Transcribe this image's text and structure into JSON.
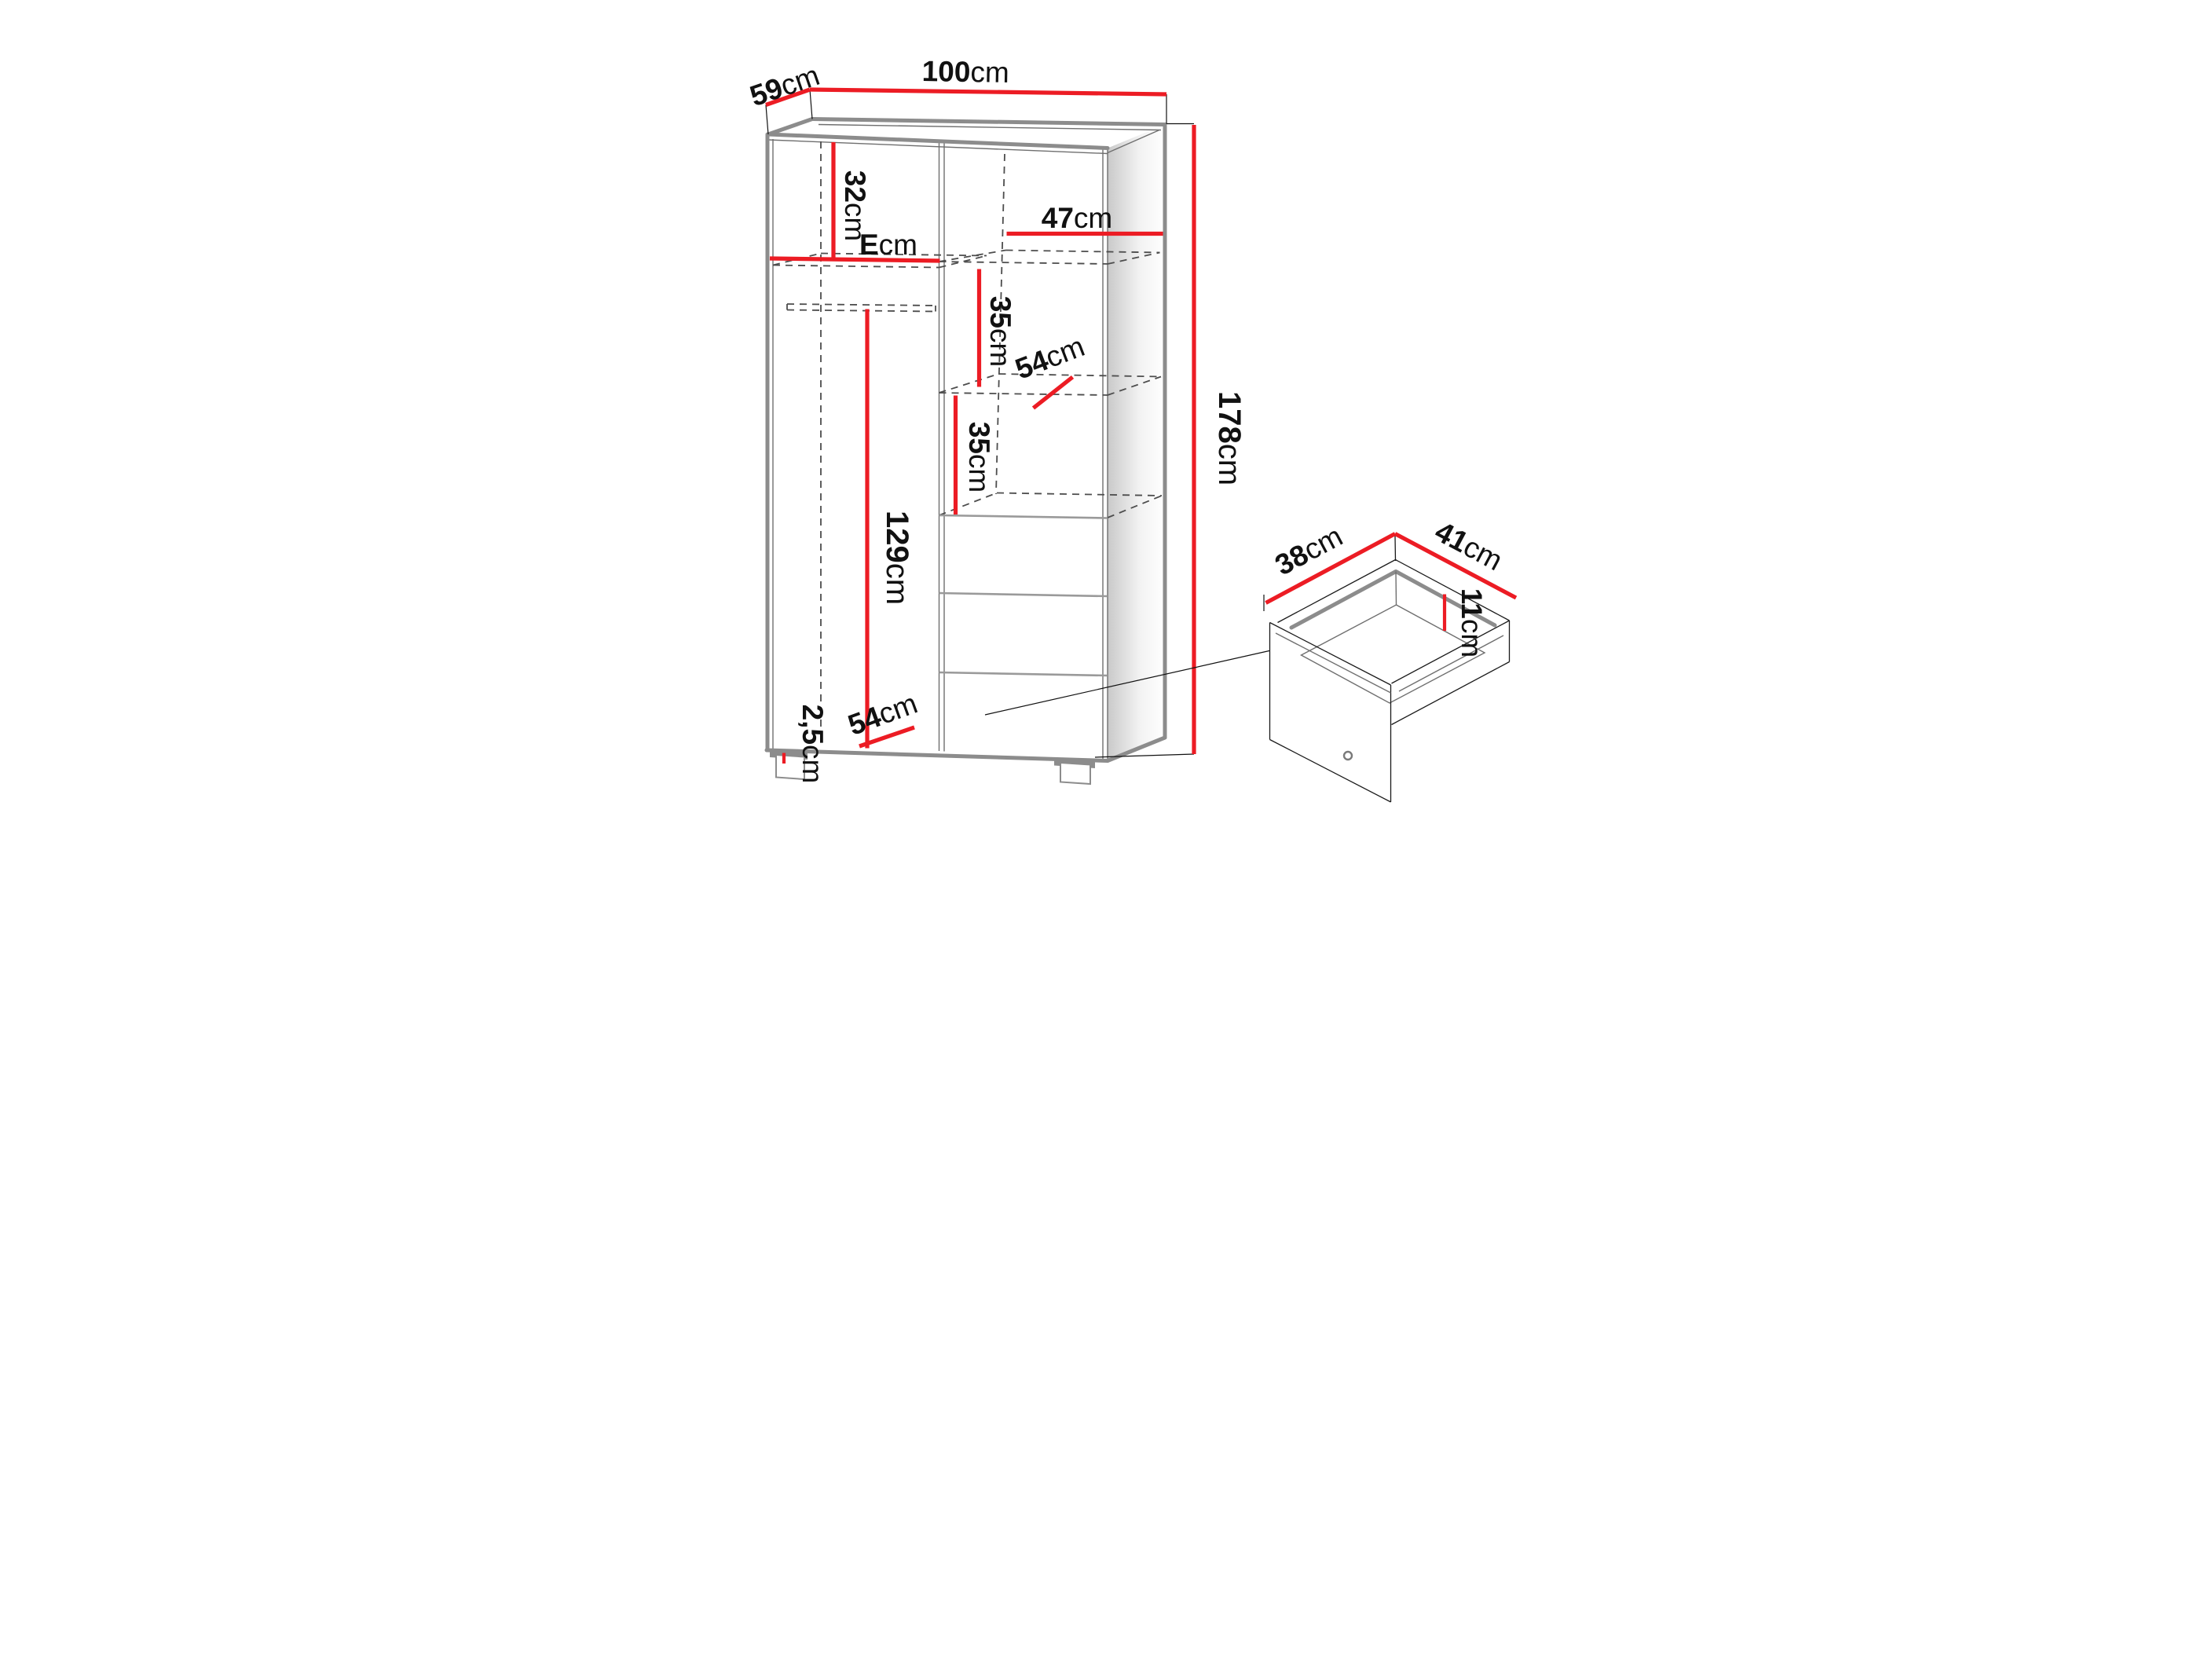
{
  "diagram_type": "furniture-dimension-drawing",
  "subject": "two-door wardrobe with shelves, hanging rail and three drawers, plus detail view of a drawer box",
  "colors": {
    "dimension_line": "#EC1C24",
    "outline_gray": "#8C8C8C",
    "outline_dark": "#1A1A1A",
    "hidden_line": "#4D4D4D",
    "label_text": "#111111",
    "background": "#FFFFFF"
  },
  "wardrobe": {
    "labels": {
      "depth_top": {
        "value": "59",
        "unit": "cm"
      },
      "width_top": {
        "value": "100",
        "unit": "cm"
      },
      "upper_section": {
        "value": "32",
        "unit": "cm"
      },
      "left_shelf_width": {
        "value": "E",
        "unit": "cm"
      },
      "right_shelf_width": {
        "value": "47",
        "unit": "cm"
      },
      "shelf_gap_upper": {
        "value": "35",
        "unit": "cm"
      },
      "shelf_depth": {
        "value": "54",
        "unit": "cm"
      },
      "shelf_gap_lower": {
        "value": "35",
        "unit": "cm"
      },
      "hanging_space": {
        "value": "129",
        "unit": "cm"
      },
      "total_height": {
        "value": "178",
        "unit": "cm"
      },
      "plinth_height": {
        "value": "2,5",
        "unit": "cm"
      },
      "bottom_depth": {
        "value": "54",
        "unit": "cm"
      }
    }
  },
  "drawer_detail": {
    "labels": {
      "inner_depth": {
        "value": "38",
        "unit": "cm"
      },
      "inner_width": {
        "value": "41",
        "unit": "cm"
      },
      "inner_height": {
        "value": "11",
        "unit": "cm"
      }
    }
  }
}
